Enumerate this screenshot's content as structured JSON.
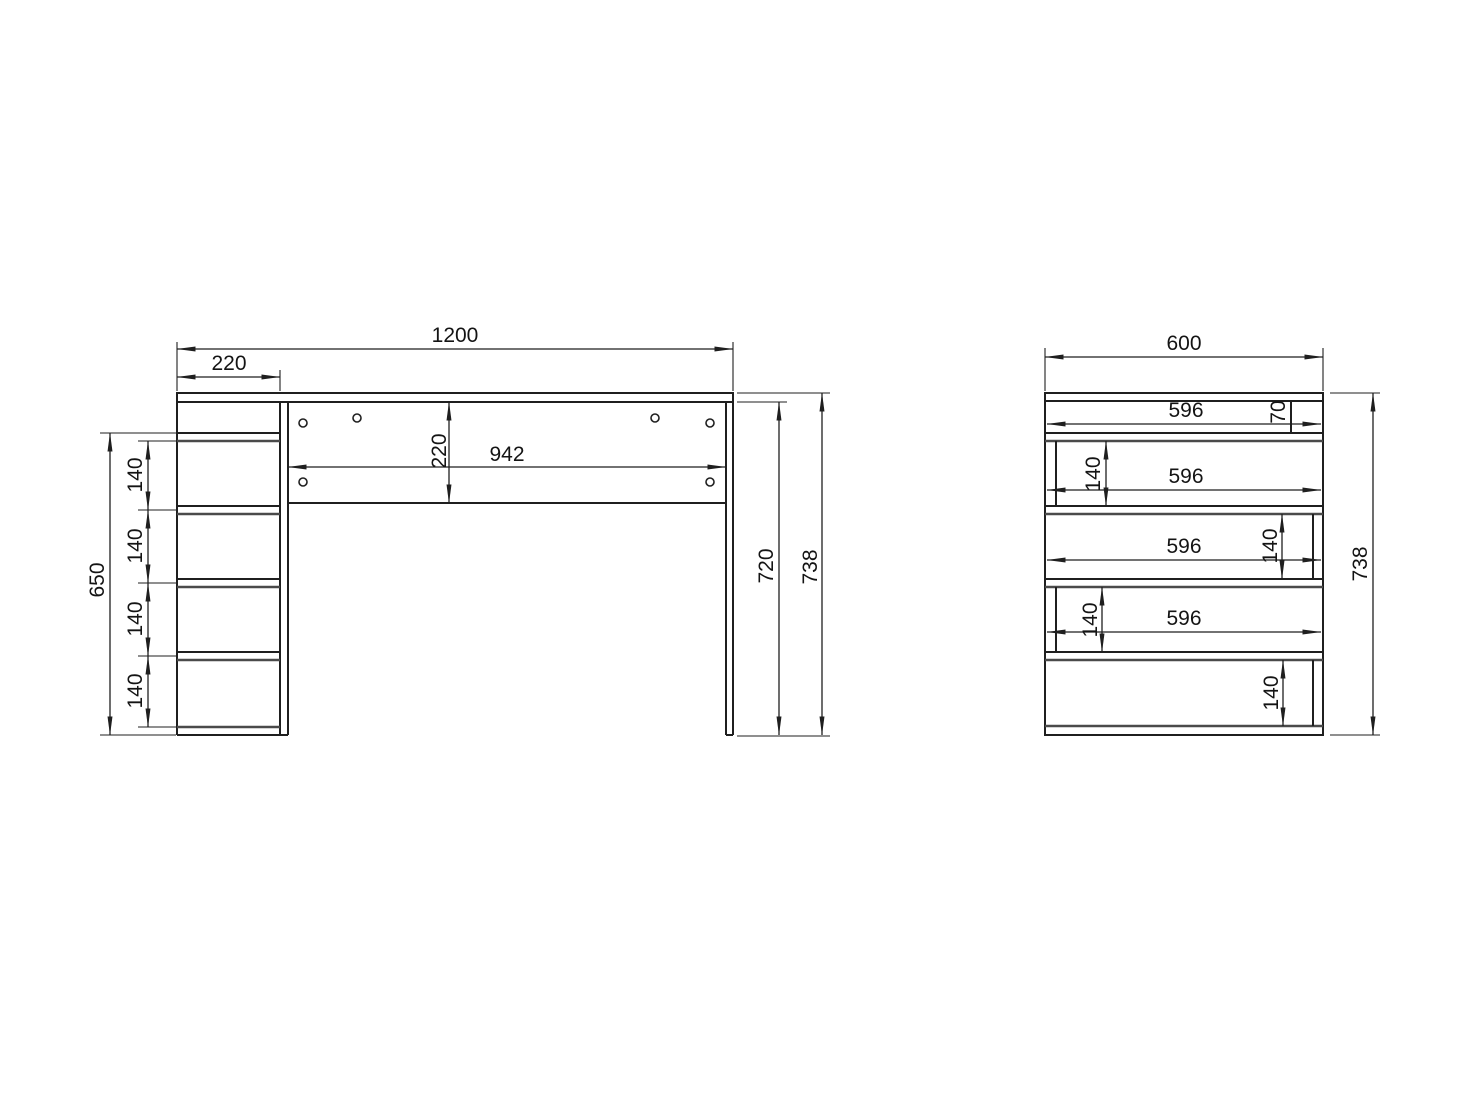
{
  "front_view": {
    "total_width": "1200",
    "pedestal_width": "220",
    "pedestal_height": "650",
    "compartments": [
      "140",
      "140",
      "140",
      "140"
    ],
    "back_panel_height": "220",
    "back_panel_width": "942",
    "clearance_height": "720",
    "total_height": "738"
  },
  "side_view": {
    "total_depth": "600",
    "top_rail_depth": "70",
    "shelf_depths": [
      "596",
      "596",
      "596",
      "596"
    ],
    "compartments": [
      "140",
      "140",
      "140",
      "140"
    ],
    "total_height": "738"
  }
}
